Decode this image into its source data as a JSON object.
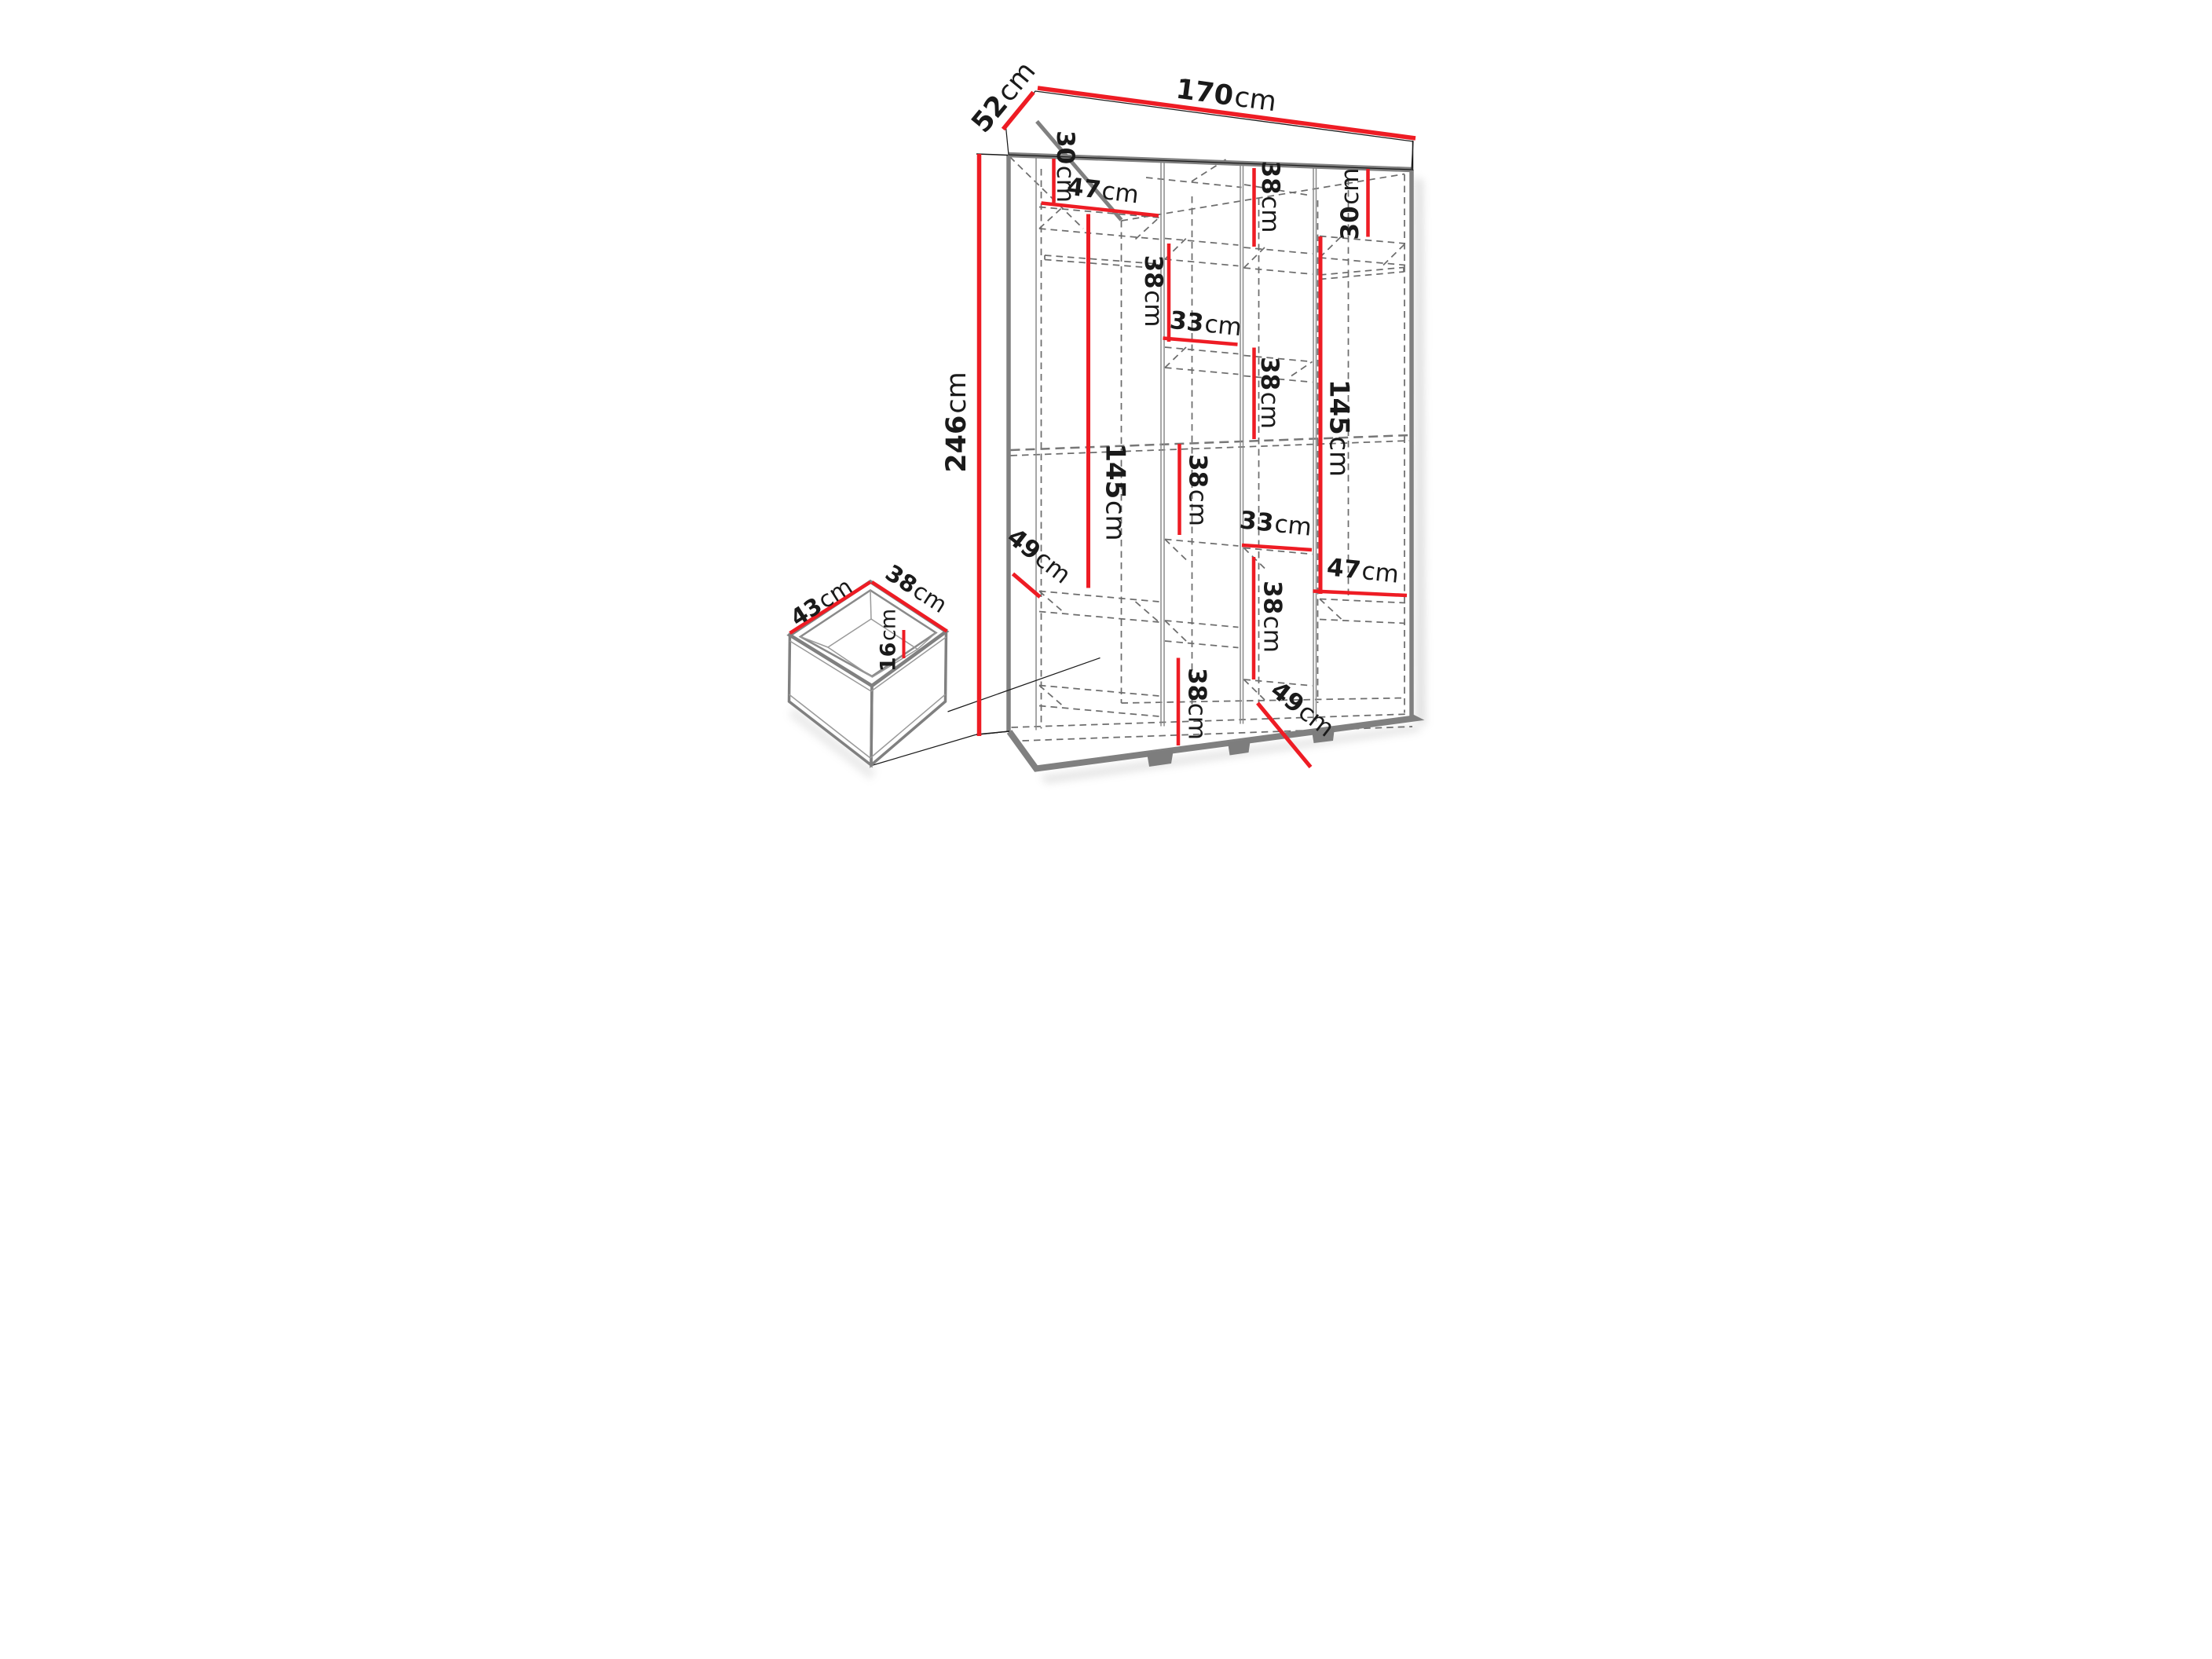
{
  "title": "Wardrobe dimensions diagram",
  "colors": {
    "dimension_red": "#ee1c24",
    "edge_gray": "#808080",
    "dash_gray": "#6d6d6d",
    "text_black": "#1a1a1a",
    "background": "#ffffff"
  },
  "wardrobe": {
    "overall_width": {
      "value": "170",
      "unit": "cm"
    },
    "overall_depth": {
      "value": "52",
      "unit": "cm"
    },
    "overall_height": {
      "value": "246",
      "unit": "cm"
    },
    "col1_top_section": {
      "value": "30",
      "unit": "cm"
    },
    "col1_shelf_width": {
      "value": "47",
      "unit": "cm"
    },
    "col1_hanging_space": {
      "value": "145",
      "unit": "cm"
    },
    "col1_depth_diag": {
      "value": "49",
      "unit": "cm"
    },
    "col2_upper_section": {
      "value": "38",
      "unit": "cm"
    },
    "col2_shelf_width": {
      "value": "33",
      "unit": "cm"
    },
    "col2_middle_section": {
      "value": "38",
      "unit": "cm"
    },
    "col2_bottom_section": {
      "value": "38",
      "unit": "cm"
    },
    "col3_top_section": {
      "value": "38",
      "unit": "cm"
    },
    "col3_middle_section": {
      "value": "38",
      "unit": "cm"
    },
    "col3_shelf_width": {
      "value": "33",
      "unit": "cm"
    },
    "col3_lower_section": {
      "value": "38",
      "unit": "cm"
    },
    "col4_top_section": {
      "value": "30",
      "unit": "cm"
    },
    "col4_hanging_space": {
      "value": "145",
      "unit": "cm"
    },
    "col4_shelf_width": {
      "value": "47",
      "unit": "cm"
    },
    "col4_depth_diag": {
      "value": "49",
      "unit": "cm"
    }
  },
  "drawer": {
    "depth": {
      "value": "43",
      "unit": "cm"
    },
    "width": {
      "value": "38",
      "unit": "cm"
    },
    "height": {
      "value": "16",
      "unit": "cm"
    }
  }
}
